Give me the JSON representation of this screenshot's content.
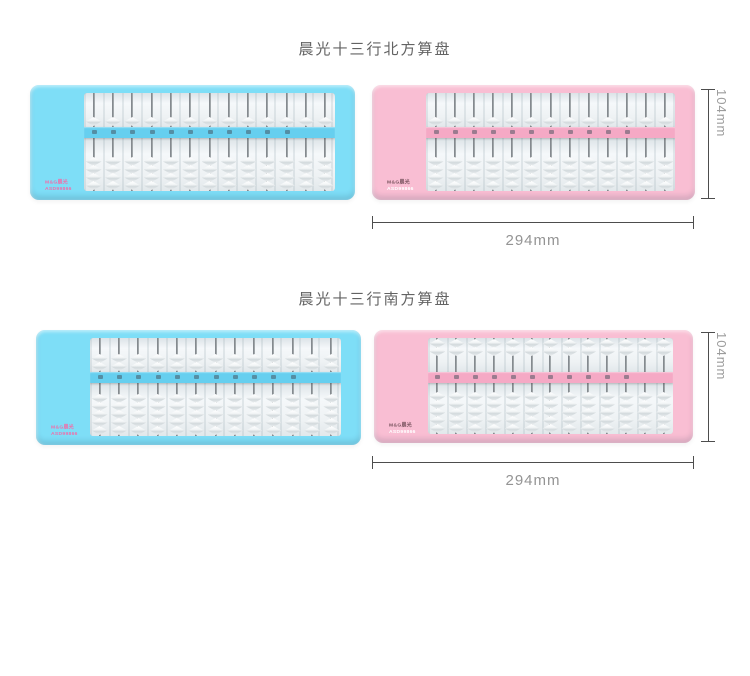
{
  "sections": [
    {
      "title": "晨光十三行北方算盘",
      "height_label": "104mm",
      "width_label": "294mm"
    },
    {
      "title": "晨光十三行南方算盘",
      "height_label": "104mm",
      "width_label": "294mm"
    }
  ],
  "logo": {
    "brand": "M&G晨光",
    "model": "ASD99866"
  },
  "abacuses": [
    {
      "name": "north-blue",
      "frame_color": "#7edef7",
      "beam_color": "#66cfef",
      "rods": 13,
      "upper_beads": 1,
      "lower_beads": 4,
      "upper_position": "down",
      "marked_rods": 11,
      "logo_brand_color": "#ef6faa",
      "logo_model_color": "#ef6faa"
    },
    {
      "name": "north-pink",
      "frame_color": "#f9bed3",
      "beam_color": "#f5a9c5",
      "rods": 13,
      "upper_beads": 1,
      "lower_beads": 4,
      "upper_position": "down",
      "marked_rods": 11,
      "logo_brand_color": "#7a5560",
      "logo_model_color": "#ffffff"
    },
    {
      "name": "south-blue",
      "frame_color": "#7edef7",
      "beam_color": "#66cfef",
      "rods": 13,
      "upper_beads": 2,
      "lower_beads": 5,
      "upper_position": "down",
      "marked_rods": 11,
      "logo_brand_color": "#ef6faa",
      "logo_model_color": "#ef6faa"
    },
    {
      "name": "south-pink",
      "frame_color": "#f9bed3",
      "beam_color": "#f5a9c5",
      "rods": 13,
      "upper_beads": 2,
      "lower_beads": 5,
      "upper_position": "up",
      "marked_rods": 11,
      "logo_brand_color": "#7a5560",
      "logo_model_color": "#ffffff"
    }
  ]
}
